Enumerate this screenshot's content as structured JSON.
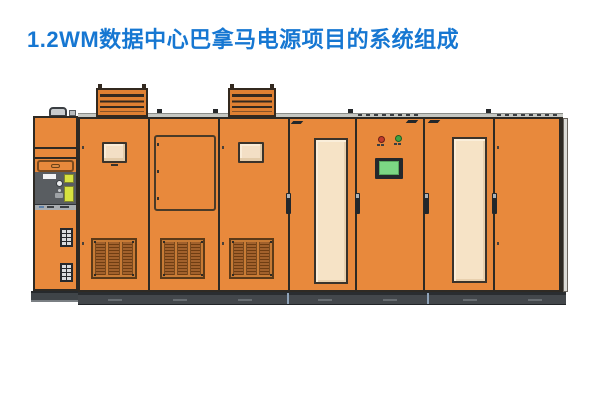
{
  "title": {
    "text": "1.2WM数据中心巴拿马电源项目的系统组成",
    "color": "#1677D2"
  },
  "illustration": {
    "kind": "power-cabinet-lineup-front-view",
    "colors": {
      "cabinet_orange": "#E8893C",
      "outline_dark": "#2E2A24",
      "window_beige": "#F3DFC5",
      "filter_panel_beige": "#F6E3C6",
      "grille_brown": "#A2612C",
      "control_panel_gray": "#595D61",
      "accent_yellow": "#D7E23F",
      "screen_green": "#7CD784",
      "indicator_red": "#C23B2C",
      "indicator_green": "#3FA344",
      "plinth_gray": "#43474B"
    },
    "cabinets": [
      {
        "id": "cabinet-1",
        "features": [
          "lift-handle",
          "drawer",
          "gray-control-panel",
          "yellow-labels",
          "knob",
          "terminal-block",
          "terminal-block"
        ]
      },
      {
        "id": "cabinet-2",
        "features": [
          "roof-vent",
          "viewing-window",
          "bottom-grille"
        ]
      },
      {
        "id": "cabinet-3",
        "features": [
          "door-outline",
          "bottom-grille"
        ]
      },
      {
        "id": "cabinet-4",
        "features": [
          "roof-vent",
          "viewing-window",
          "bottom-grille"
        ]
      },
      {
        "id": "cabinet-5",
        "features": [
          "filter-panel",
          "door-handle",
          "corner-latch"
        ]
      },
      {
        "id": "cabinet-6",
        "features": [
          "red-indicator",
          "green-indicator",
          "hmi-screen",
          "door-handle",
          "corner-latch"
        ]
      },
      {
        "id": "cabinet-7",
        "features": [
          "filter-panel",
          "door-handle",
          "corner-latch"
        ]
      },
      {
        "id": "cabinet-8",
        "features": [
          "door-handle"
        ]
      }
    ]
  }
}
